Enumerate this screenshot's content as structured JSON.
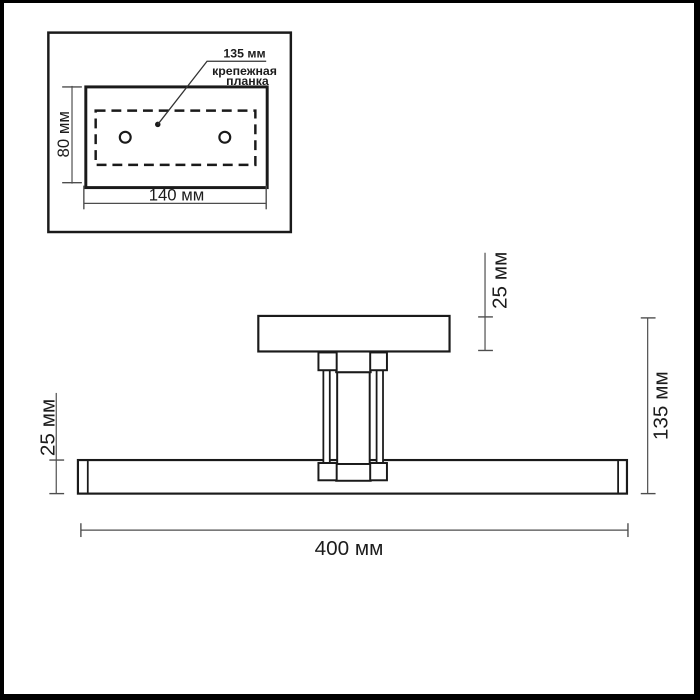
{
  "inset": {
    "hole_spacing_label": "135 мм",
    "plate_label_line1": "крепежная",
    "plate_label_line2": "планка",
    "plate_height": "80 мм",
    "plate_width": "140 мм"
  },
  "main": {
    "base_height": "25 мм",
    "bar_height": "25 мм",
    "total_height": "135 мм",
    "bar_length": "400 мм"
  },
  "colors": {
    "outline": "#1a1a1a",
    "dimension_line": "#4d4d4d",
    "text": "#1c1c1c",
    "background": "#ffffff",
    "frame": "#000000"
  }
}
